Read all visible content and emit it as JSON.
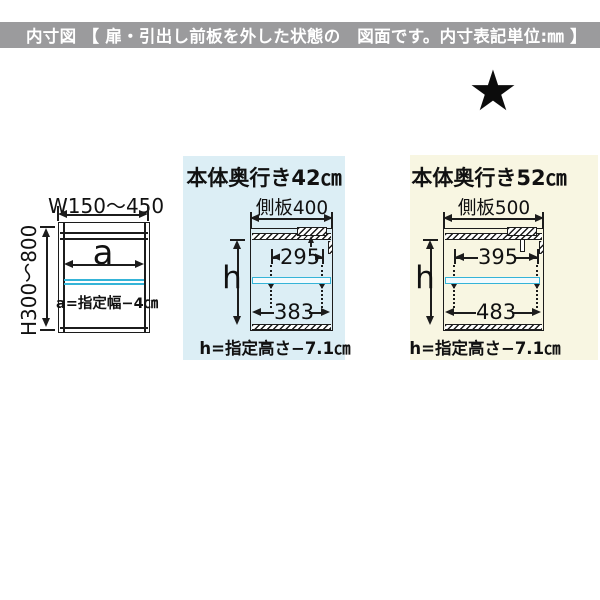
{
  "header": {
    "title": "内寸図 【 扉・引出し前板を外した状態の　図面です。内寸表記単位:㎜ 】"
  },
  "star": {
    "glyph": "★"
  },
  "colors": {
    "header_bar": "#9b9b9d",
    "panel_depth42_bg": "#dceef5",
    "panel_depth52_bg": "#f8f6e2",
    "shelf_cyan": "#35b4d8",
    "line": "#1c1c1c"
  },
  "front_diagram": {
    "width_range": "W150～450",
    "height_range": "H300～800",
    "inner_width_label": "a",
    "inner_width_formula": "a=指定幅−4㎝"
  },
  "depth42_diagram": {
    "title": "本体奥行き42㎝",
    "side_panel_label": "側板400",
    "inner_height_label": "h",
    "shelf_pitch_width": "295",
    "inner_width": "383",
    "inner_height_formula": "h=指定高さ−7.1㎝"
  },
  "depth52_diagram": {
    "title": "本体奥行き52㎝",
    "side_panel_label": "側板500",
    "inner_height_label": "h",
    "shelf_pitch_width": "395",
    "inner_width": "483",
    "inner_height_formula": "h=指定高さ−7.1㎝"
  }
}
